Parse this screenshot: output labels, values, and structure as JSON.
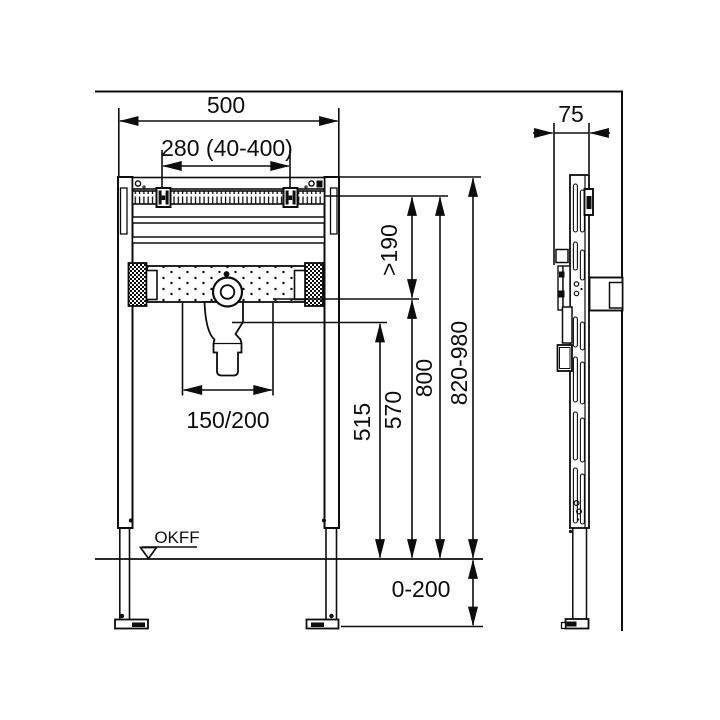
{
  "drawing": {
    "title": "washbasin-mounting-frame-technical-drawing",
    "dims": {
      "width": "500",
      "fixing": "280 (40-400)",
      "depth": "75",
      "clearance": ">190",
      "drain_height": "515",
      "tap_height": "570",
      "rail_height": "800",
      "frame_height": "820-980",
      "drain_offset": "150/200",
      "leg_range": "0-200",
      "floor": "OKFF"
    }
  }
}
